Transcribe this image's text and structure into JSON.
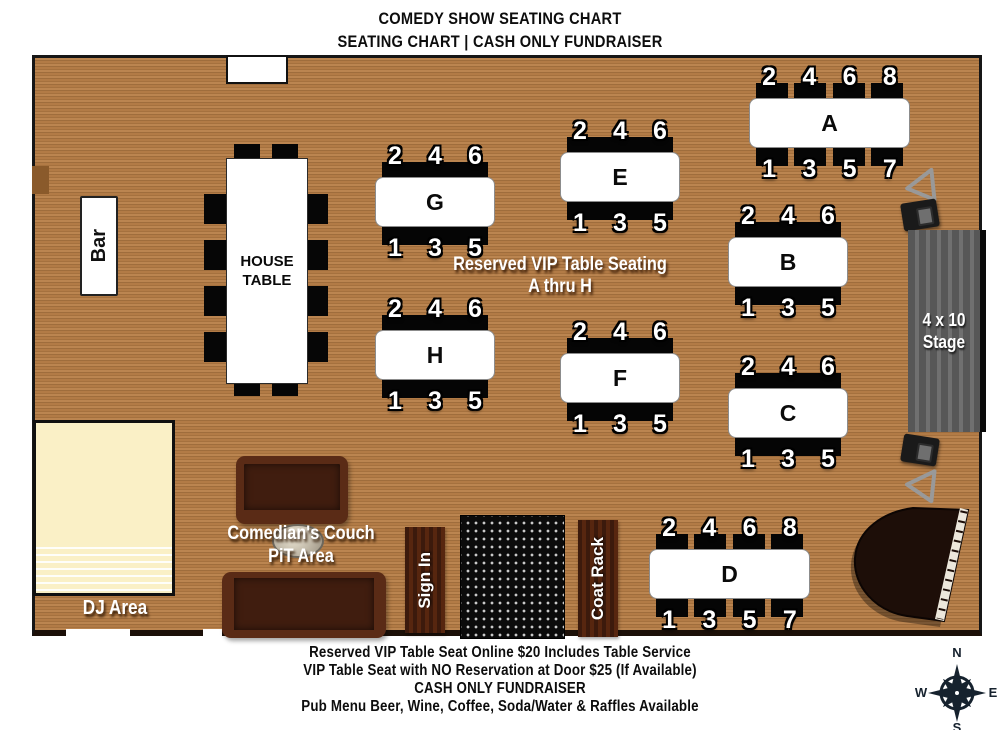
{
  "title": {
    "line1": "COMEDY SHOW SEATING CHART",
    "line2": "SEATING CHART | CASH ONLY FUNDRAISER"
  },
  "vip_note": {
    "line1": "Reserved VIP Table Seating",
    "line2": "A thru H"
  },
  "labels": {
    "bar": "Bar",
    "house_table_line1": "HOUSE",
    "house_table_line2": "TABLE",
    "stage_line1": "4 x 10",
    "stage_line2": "Stage",
    "dj_area": "DJ Area",
    "couch_line1": "Comedian's Couch",
    "couch_line2": "PiT Area",
    "sign_in": "Sign In",
    "coat_rack": "Coat Rack"
  },
  "tables": [
    {
      "label": "A",
      "seats_top": [
        "2",
        "4",
        "6",
        "8"
      ],
      "seats_bottom": [
        "1",
        "3",
        "5",
        "7"
      ]
    },
    {
      "label": "B",
      "seats_top": [
        "2",
        "4",
        "6"
      ],
      "seats_bottom": [
        "1",
        "3",
        "5"
      ]
    },
    {
      "label": "C",
      "seats_top": [
        "2",
        "4",
        "6"
      ],
      "seats_bottom": [
        "1",
        "3",
        "5"
      ]
    },
    {
      "label": "D",
      "seats_top": [
        "2",
        "4",
        "6",
        "8"
      ],
      "seats_bottom": [
        "1",
        "3",
        "5",
        "7"
      ]
    },
    {
      "label": "E",
      "seats_top": [
        "2",
        "4",
        "6"
      ],
      "seats_bottom": [
        "1",
        "3",
        "5"
      ]
    },
    {
      "label": "F",
      "seats_top": [
        "2",
        "4",
        "6"
      ],
      "seats_bottom": [
        "1",
        "3",
        "5"
      ]
    },
    {
      "label": "G",
      "seats_top": [
        "2",
        "4",
        "6"
      ],
      "seats_bottom": [
        "1",
        "3",
        "5"
      ]
    },
    {
      "label": "H",
      "seats_top": [
        "2",
        "4",
        "6"
      ],
      "seats_bottom": [
        "1",
        "3",
        "5"
      ]
    }
  ],
  "compass": {
    "n": "N",
    "e": "E",
    "s": "S",
    "w": "W"
  },
  "footer": {
    "line1": "Reserved VIP Table Seat Online $20 Includes Table Service",
    "line2": "VIP Table Seat with NO Reservation at Door $25  (If Available)",
    "line3": "CASH ONLY FUNDRAISER",
    "line4": "Pub Menu Beer, Wine, Coffee, Soda/Water & Raffles Available"
  },
  "colors": {
    "wood": "#ab7442",
    "wall": "#161616",
    "stage_gray": "#5c5c5c",
    "couch_brown": "#401d0f",
    "dj_cream": "#faf0c6",
    "compass_navy": "#16222e"
  }
}
